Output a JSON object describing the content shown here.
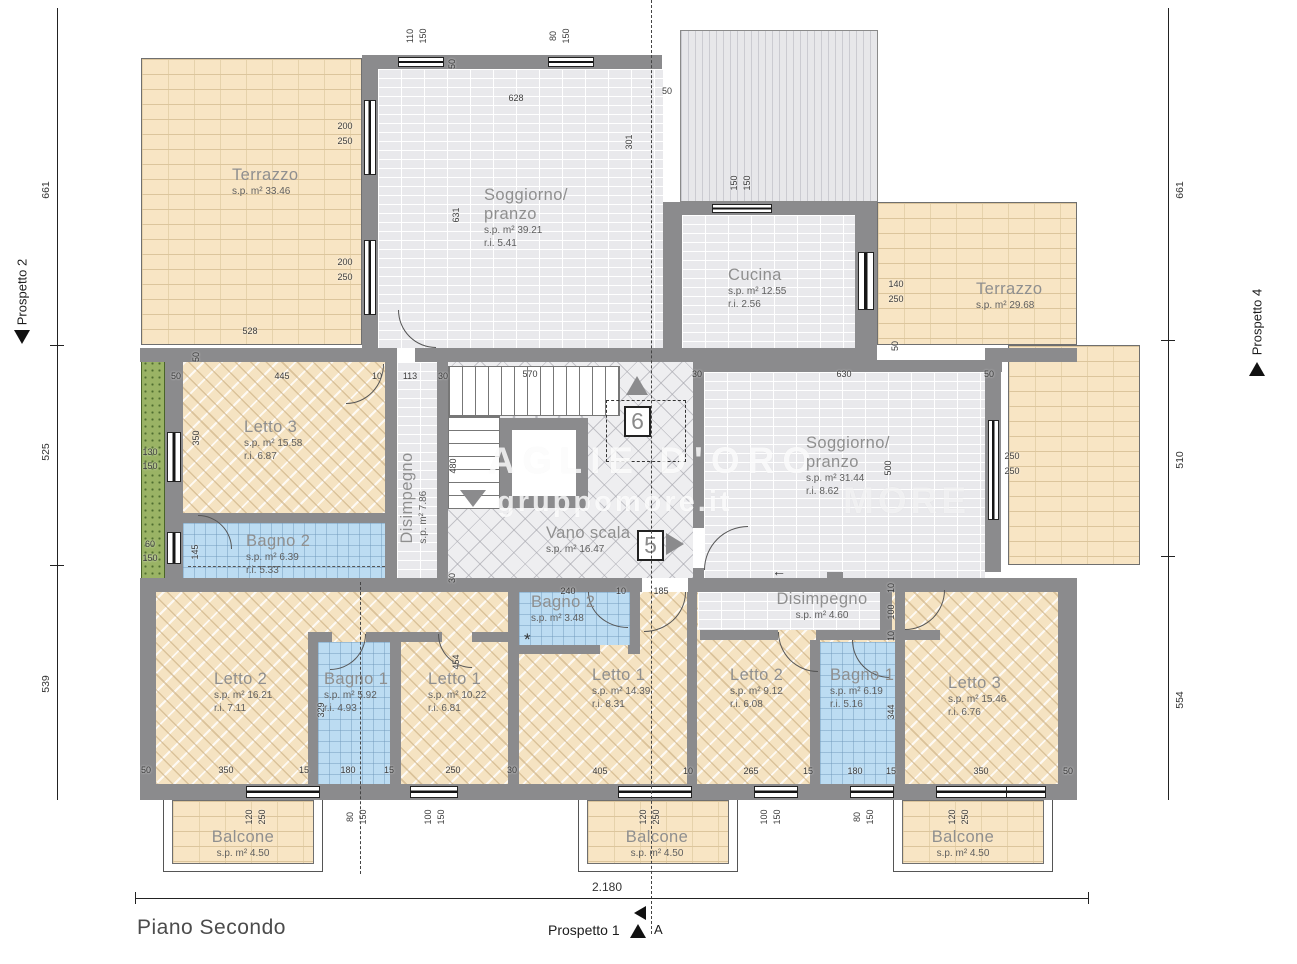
{
  "page": {
    "floor_label": "Piano Secondo"
  },
  "section_markers": {
    "prospetto1": "Prospetto 1",
    "prospetto2": "Prospetto 2",
    "prospetto4": "Prospetto 4",
    "section_letter": "A",
    "apartment_5": "5",
    "apartment_6": "6"
  },
  "overall_width_label": "2.180",
  "rulers": {
    "left": [
      "661",
      "525",
      "539"
    ],
    "right": [
      "661",
      "510",
      "554"
    ]
  },
  "watermark": {
    "line1": "AGLIE D'ORO",
    "line2": "gruppomore.it",
    "line3": "MORE"
  },
  "symbols": {
    "asterisk": "*",
    "arrow_left": "←"
  },
  "colors": {
    "wall": "#8b8b8d",
    "terrace_tile": "#f8e5c4",
    "bedroom_hatch": "#f5e3c2",
    "bathroom_tile": "#bcdcf2",
    "room_brick": "#e9e9ec",
    "stair_floor": "#eeeef0",
    "planter_green": "#9ab365"
  },
  "room_labels": [
    {
      "id": "terrazzo-top-left",
      "name": "Terrazzo",
      "sp": "s.p. m² 33.46",
      "x": 232,
      "y": 166
    },
    {
      "id": "soggiorno-pranzo-top",
      "name": "Soggiorno/",
      "name2": "pranzo",
      "sp": "s.p. m² 39.21",
      "ri": "r.i. 5.41",
      "x": 484,
      "y": 186
    },
    {
      "id": "cucina",
      "name": "Cucina",
      "sp": "s.p. m² 12.55",
      "ri": "r.i. 2.56",
      "x": 728,
      "y": 266
    },
    {
      "id": "terrazzo-right",
      "name": "Terrazzo",
      "sp": "s.p. m² 29.68",
      "x": 976,
      "y": 280
    },
    {
      "id": "letto3-mid-left",
      "name": "Letto 3",
      "sp": "s.p. m² 15.58",
      "ri": "r.i. 6.87",
      "x": 244,
      "y": 418
    },
    {
      "id": "bagno2-mid-left",
      "name": "Bagno 2",
      "sp": "s.p. m² 6.39",
      "ri": "r.i. 5.33",
      "x": 246,
      "y": 532
    },
    {
      "id": "disimpegno-vert",
      "name": "Disimpegno",
      "sp": "s.p. m² 7.86",
      "x": 414,
      "y": 498,
      "rot": true
    },
    {
      "id": "vano-scala",
      "name": "Vano scala",
      "sp": "s.p. m² 16.47",
      "x": 546,
      "y": 524
    },
    {
      "id": "soggiorno-pranzo-right",
      "name": "Soggiorno/",
      "name2": "pranzo",
      "sp": "s.p. m² 31.44",
      "ri": "r.i. 8.62",
      "x": 806,
      "y": 434
    },
    {
      "id": "bagno2-small",
      "name": "Bagno 2",
      "sp": "s.p. m² 3.48",
      "x": 531,
      "y": 593
    },
    {
      "id": "disimpegno-horiz",
      "name": "Disimpegno",
      "sp": "s.p. m² 4.60",
      "x": 822,
      "y": 590,
      "c": true
    },
    {
      "id": "letto2-bottom-left",
      "name": "Letto 2",
      "sp": "s.p. m² 16.21",
      "ri": "r.i. 7.11",
      "x": 214,
      "y": 670
    },
    {
      "id": "bagno1-bottom-left",
      "name": "Bagno 1",
      "sp": "s.p. m² 5.92",
      "ri": "r.i. 4.93",
      "x": 324,
      "y": 670
    },
    {
      "id": "letto1-bottom-left",
      "name": "Letto 1",
      "sp": "s.p. m² 10.22",
      "ri": "r.i. 6.81",
      "x": 428,
      "y": 670
    },
    {
      "id": "letto1-bottom-center",
      "name": "Letto 1",
      "sp": "s.p. m² 14.39",
      "ri": "r.i. 8.31",
      "x": 592,
      "y": 666
    },
    {
      "id": "letto2-bottom-right",
      "name": "Letto 2",
      "sp": "s.p. m² 9.12",
      "ri": "r.i. 6.08",
      "x": 730,
      "y": 666
    },
    {
      "id": "bagno1-bottom-right",
      "name": "Bagno 1",
      "sp": "s.p. m² 6.19",
      "ri": "r.i. 5.16",
      "x": 830,
      "y": 666
    },
    {
      "id": "letto3-bottom-right",
      "name": "Letto 3",
      "sp": "s.p. m² 15.46",
      "ri": "r.i. 6.76",
      "x": 948,
      "y": 674
    },
    {
      "id": "balcone-left",
      "name": "Balcone",
      "sp": "s.p. m² 4.50",
      "x": 243,
      "y": 828,
      "c": true
    },
    {
      "id": "balcone-center",
      "name": "Balcone",
      "sp": "s.p. m² 4.50",
      "x": 657,
      "y": 828,
      "c": true
    },
    {
      "id": "balcone-right",
      "name": "Balcone",
      "sp": "s.p. m² 4.50",
      "x": 963,
      "y": 828,
      "c": true
    }
  ],
  "dimensions": [
    {
      "t": "110",
      "x": 410,
      "y": 36,
      "v": 1
    },
    {
      "t": "150",
      "x": 423,
      "y": 36,
      "v": 1
    },
    {
      "t": "80",
      "x": 553,
      "y": 36,
      "v": 1
    },
    {
      "t": "150",
      "x": 566,
      "y": 36,
      "v": 1
    },
    {
      "t": "50",
      "x": 452,
      "y": 64,
      "v": 1
    },
    {
      "t": "628",
      "x": 516,
      "y": 98
    },
    {
      "t": "50",
      "x": 667,
      "y": 91
    },
    {
      "t": "631",
      "x": 456,
      "y": 215,
      "v": 1
    },
    {
      "t": "301",
      "x": 629,
      "y": 142,
      "v": 1
    },
    {
      "t": "200",
      "x": 345,
      "y": 126
    },
    {
      "t": "250",
      "x": 345,
      "y": 141
    },
    {
      "t": "200",
      "x": 345,
      "y": 262
    },
    {
      "t": "250",
      "x": 345,
      "y": 277
    },
    {
      "t": "528",
      "x": 250,
      "y": 331
    },
    {
      "t": "150",
      "x": 734,
      "y": 183,
      "v": 1
    },
    {
      "t": "150",
      "x": 747,
      "y": 183,
      "v": 1
    },
    {
      "t": "140",
      "x": 896,
      "y": 284
    },
    {
      "t": "250",
      "x": 896,
      "y": 299
    },
    {
      "t": "50",
      "x": 895,
      "y": 346,
      "v": 1
    },
    {
      "t": "50",
      "x": 196,
      "y": 357,
      "v": 1
    },
    {
      "t": "50",
      "x": 176,
      "y": 376
    },
    {
      "t": "445",
      "x": 282,
      "y": 376
    },
    {
      "t": "10",
      "x": 377,
      "y": 376
    },
    {
      "t": "113",
      "x": 410,
      "y": 376
    },
    {
      "t": "30",
      "x": 443,
      "y": 376
    },
    {
      "t": "570",
      "x": 530,
      "y": 374
    },
    {
      "t": "30",
      "x": 697,
      "y": 374
    },
    {
      "t": "630",
      "x": 844,
      "y": 374
    },
    {
      "t": "50",
      "x": 989,
      "y": 374
    },
    {
      "t": "350",
      "x": 196,
      "y": 438,
      "v": 1
    },
    {
      "t": "480",
      "x": 453,
      "y": 466,
      "v": 1
    },
    {
      "t": "145",
      "x": 195,
      "y": 552,
      "v": 1
    },
    {
      "t": "130",
      "x": 150,
      "y": 452
    },
    {
      "t": "150",
      "x": 150,
      "y": 466
    },
    {
      "t": "60",
      "x": 150,
      "y": 544
    },
    {
      "t": "150",
      "x": 150,
      "y": 558
    },
    {
      "t": "500",
      "x": 888,
      "y": 468,
      "v": 1
    },
    {
      "t": "250",
      "x": 1012,
      "y": 456
    },
    {
      "t": "250",
      "x": 1012,
      "y": 471
    },
    {
      "t": "30",
      "x": 452,
      "y": 578,
      "v": 1
    },
    {
      "t": "240",
      "x": 568,
      "y": 591
    },
    {
      "t": "10",
      "x": 621,
      "y": 591
    },
    {
      "t": "185",
      "x": 661,
      "y": 591
    },
    {
      "t": "10",
      "x": 891,
      "y": 588,
      "v": 1
    },
    {
      "t": "100",
      "x": 891,
      "y": 612,
      "v": 1
    },
    {
      "t": "10",
      "x": 891,
      "y": 636,
      "v": 1
    },
    {
      "t": "329",
      "x": 321,
      "y": 710,
      "v": 1
    },
    {
      "t": "454",
      "x": 456,
      "y": 662,
      "v": 1
    },
    {
      "t": "344",
      "x": 891,
      "y": 712,
      "v": 1
    },
    {
      "t": "50",
      "x": 146,
      "y": 770
    },
    {
      "t": "350",
      "x": 226,
      "y": 770
    },
    {
      "t": "15",
      "x": 304,
      "y": 770
    },
    {
      "t": "180",
      "x": 348,
      "y": 770
    },
    {
      "t": "15",
      "x": 389,
      "y": 770
    },
    {
      "t": "250",
      "x": 453,
      "y": 770
    },
    {
      "t": "30",
      "x": 512,
      "y": 770
    },
    {
      "t": "405",
      "x": 600,
      "y": 771
    },
    {
      "t": "10",
      "x": 688,
      "y": 771
    },
    {
      "t": "265",
      "x": 751,
      "y": 771
    },
    {
      "t": "15",
      "x": 808,
      "y": 771
    },
    {
      "t": "180",
      "x": 855,
      "y": 771
    },
    {
      "t": "15",
      "x": 891,
      "y": 771
    },
    {
      "t": "350",
      "x": 981,
      "y": 771
    },
    {
      "t": "50",
      "x": 1068,
      "y": 771
    },
    {
      "t": "120",
      "x": 249,
      "y": 817,
      "v": 1
    },
    {
      "t": "250",
      "x": 262,
      "y": 817,
      "v": 1
    },
    {
      "t": "80",
      "x": 350,
      "y": 817,
      "v": 1
    },
    {
      "t": "150",
      "x": 363,
      "y": 817,
      "v": 1
    },
    {
      "t": "100",
      "x": 428,
      "y": 817,
      "v": 1
    },
    {
      "t": "150",
      "x": 441,
      "y": 817,
      "v": 1
    },
    {
      "t": "120",
      "x": 643,
      "y": 817,
      "v": 1
    },
    {
      "t": "250",
      "x": 656,
      "y": 817,
      "v": 1
    },
    {
      "t": "100",
      "x": 764,
      "y": 817,
      "v": 1
    },
    {
      "t": "150",
      "x": 777,
      "y": 817,
      "v": 1
    },
    {
      "t": "80",
      "x": 857,
      "y": 817,
      "v": 1
    },
    {
      "t": "150",
      "x": 870,
      "y": 817,
      "v": 1
    },
    {
      "t": "120",
      "x": 952,
      "y": 817,
      "v": 1
    },
    {
      "t": "250",
      "x": 965,
      "y": 817,
      "v": 1
    }
  ]
}
